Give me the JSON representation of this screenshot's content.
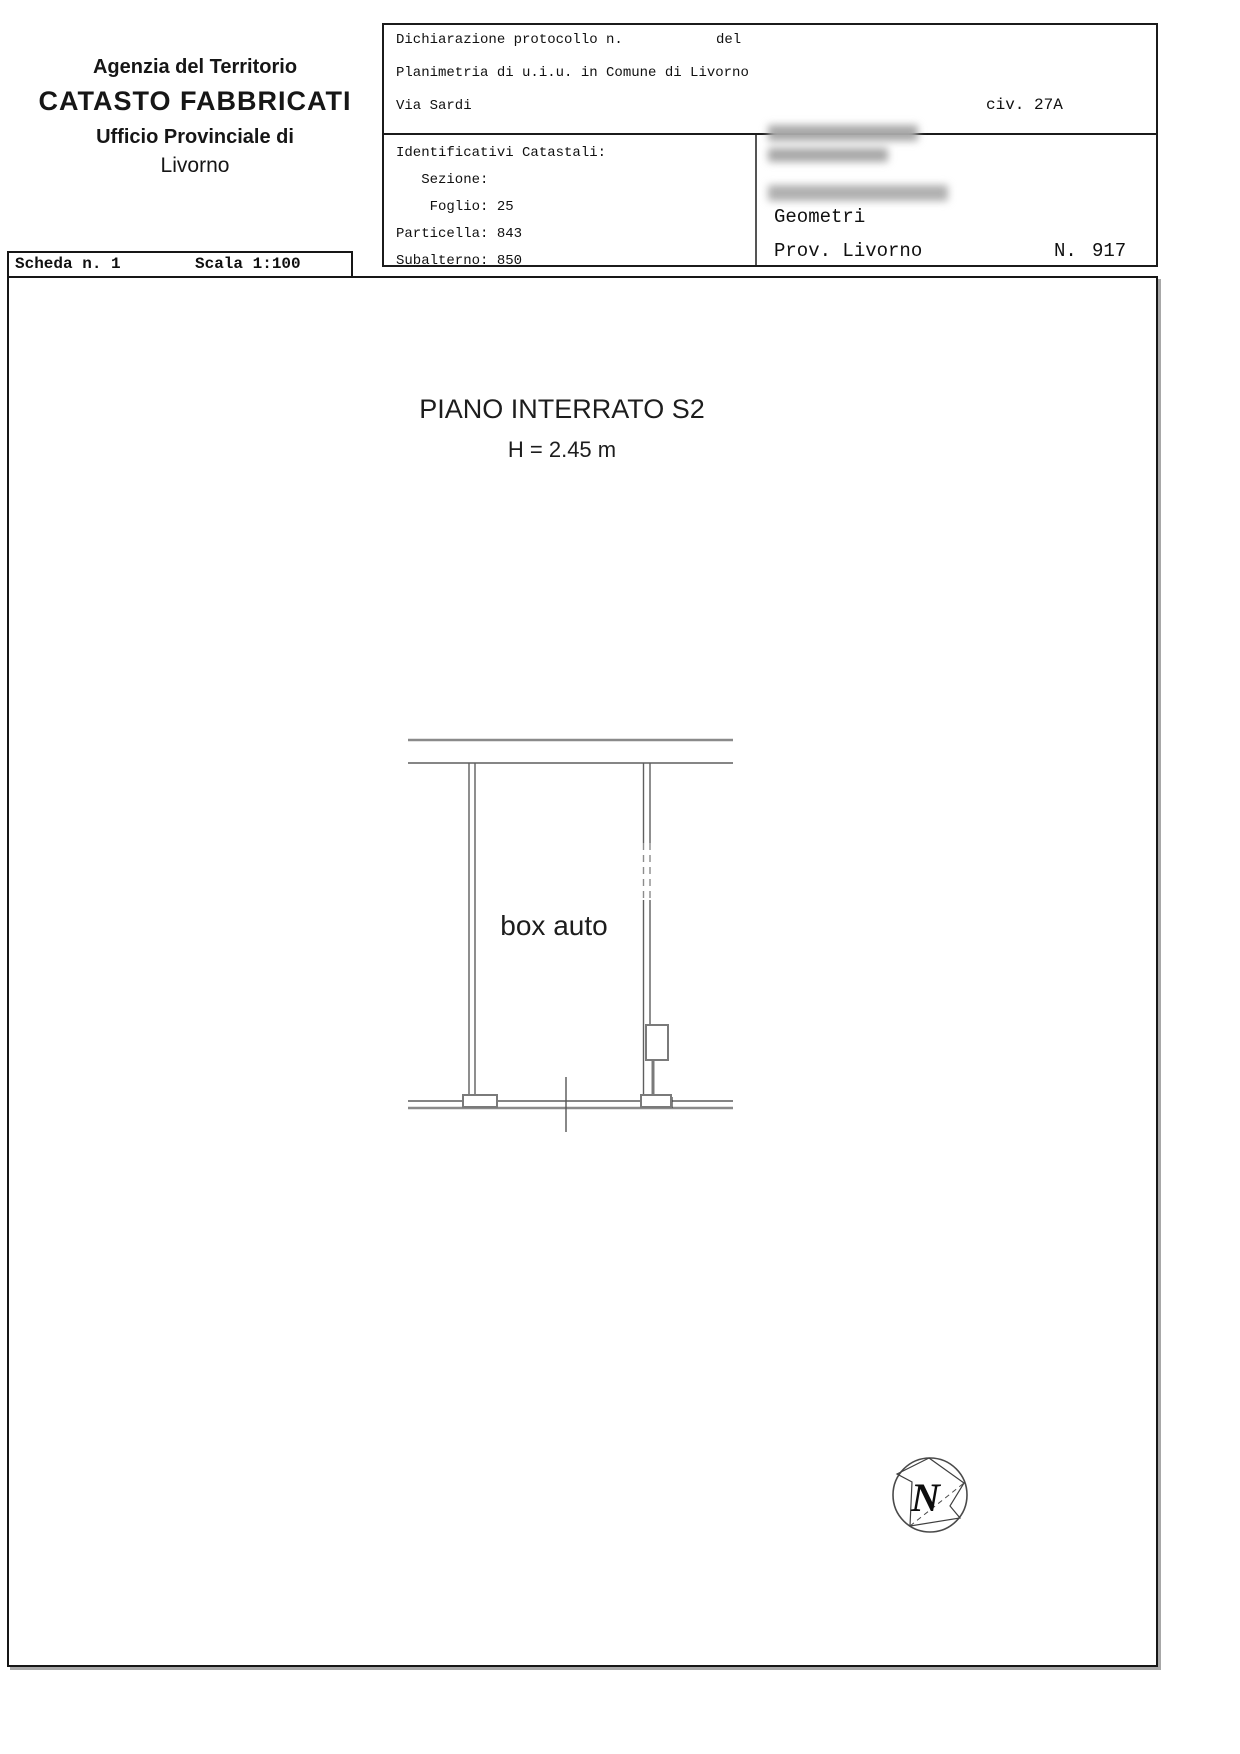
{
  "agency": {
    "line1": "Agenzia del Territorio",
    "line2": "CATASTO FABBRICATI",
    "line3": "Ufficio Provinciale di",
    "line4": "Livorno"
  },
  "declaration": {
    "protocol_label": "Dichiarazione protocollo n.",
    "protocol_del": "del",
    "planimetria": "Planimetria di u.i.u. in Comune di Livorno",
    "street": "Via Sardi",
    "civ": "civ. 27A",
    "identificativi": {
      "title": "Identificativi Catastali:",
      "sezione": "   Sezione:",
      "foglio": "    Foglio: 25",
      "particella": "Particella: 843",
      "subalterno": "Subalterno: 850"
    },
    "professional": {
      "geometri": "Geometri",
      "prov": "Prov. Livorno",
      "n_label": "N.",
      "n_value": "917"
    }
  },
  "scheda": {
    "label": "Scheda n. 1",
    "scala": "Scala 1:100"
  },
  "drawing": {
    "title": "PIANO INTERRATO S2",
    "height_label": "H = 2.45 m",
    "room_label": "box auto",
    "north_letter": "N"
  }
}
